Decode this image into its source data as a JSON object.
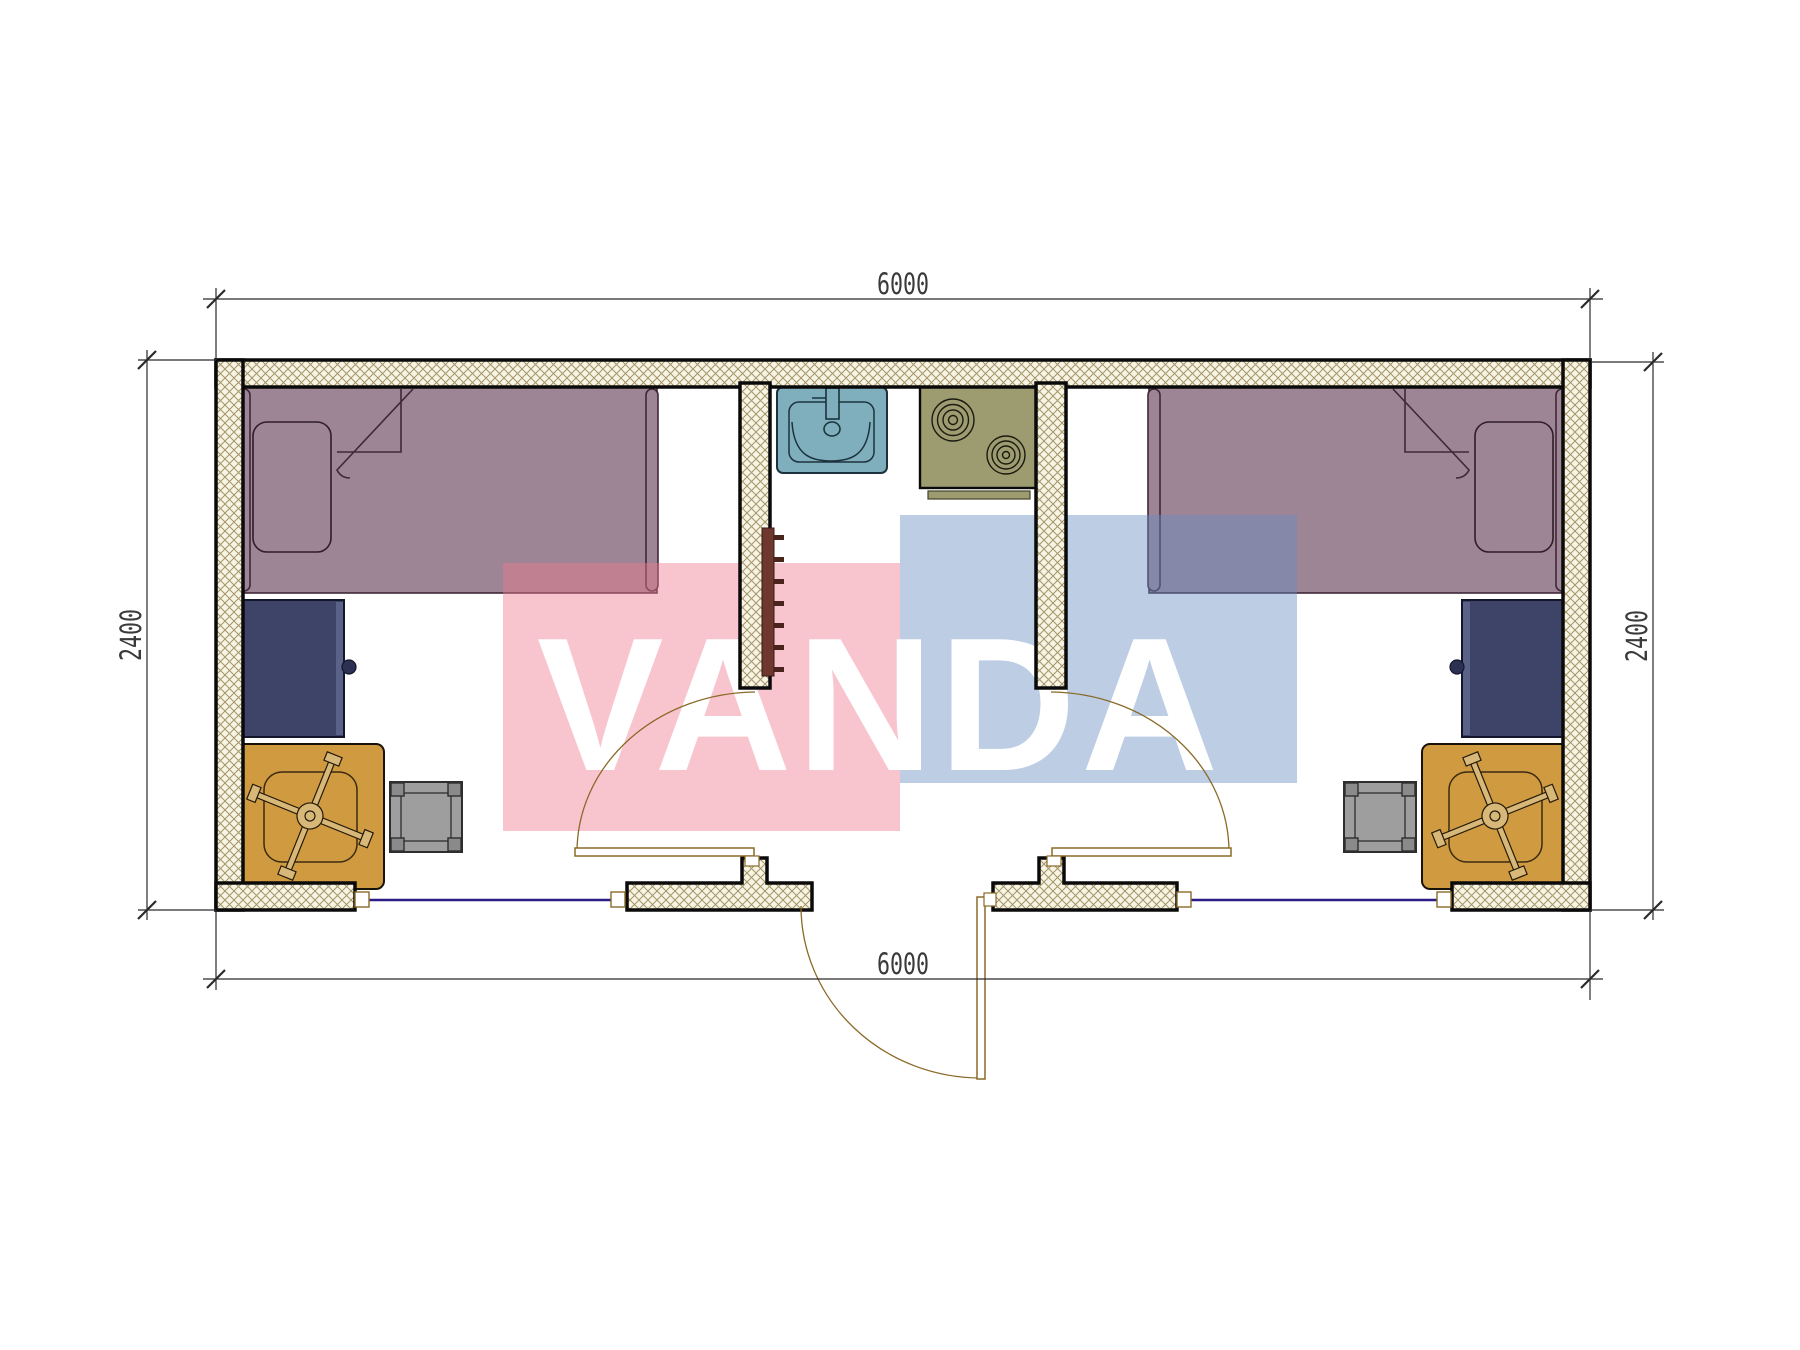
{
  "dimensions": {
    "top_width_mm": "6000",
    "bottom_width_mm": "6000",
    "left_height_mm": "2400",
    "right_height_mm": "2400"
  },
  "watermark": {
    "text": "VANDA",
    "pink_color": "#ef7b8f",
    "blue_color": "#668dc1"
  },
  "colors": {
    "bed": "#9d8595",
    "bed_outline": "#3f2838",
    "desk": "#3e4468",
    "desk_edge": "#5a6288",
    "chair": "#cf9a40",
    "chair_base": "#d8b878",
    "stool": "#9e9e9e",
    "stool_corner": "#8a8a8a",
    "sink": "#7fafbd",
    "stove": "#9c9c70",
    "coat_rack": "#6e382f",
    "window_line": "#2b1e87",
    "door_line": "#8a6a28",
    "wall_hatch_line": "#a4946a",
    "wall_fill": "#f8f4e4"
  },
  "elements": {
    "left_room": [
      "single-bed",
      "pillow",
      "desk",
      "office-chair",
      "stool",
      "interior-door"
    ],
    "right_room": [
      "single-bed",
      "pillow",
      "desk",
      "office-chair",
      "stool",
      "interior-door"
    ],
    "middle_area": [
      "sink",
      "stove-two-burners",
      "coat-rack",
      "entrance-door",
      "windows"
    ]
  }
}
